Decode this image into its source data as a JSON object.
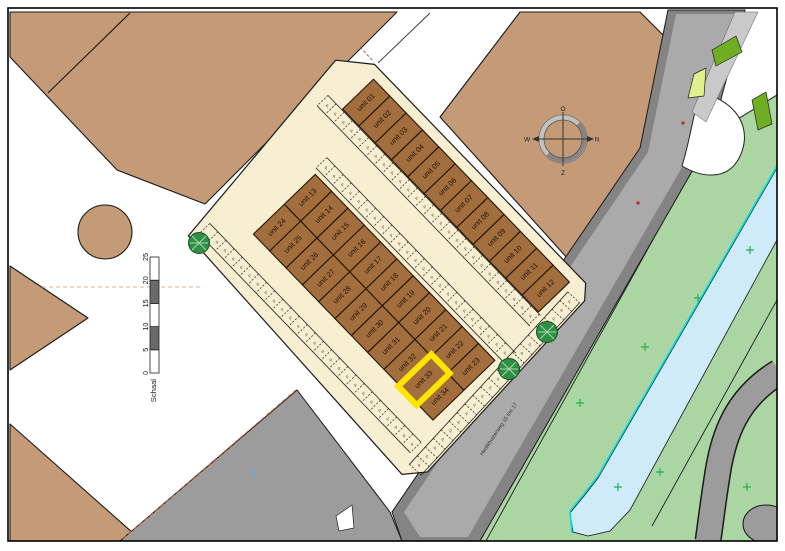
{
  "site": {
    "unit_labels": [
      "unit 01",
      "unit 02",
      "unit 03",
      "unit 04",
      "unit 05",
      "unit 06",
      "unit 07",
      "unit 08",
      "unit 09",
      "unit 10",
      "unit 11",
      "unit 12",
      "unit 13",
      "unit 14",
      "unit 15",
      "unit 16",
      "unit 17",
      "unit 18",
      "unit 19",
      "unit 20",
      "unit 21",
      "unit 22",
      "unit 23",
      "unit 24",
      "unit 25",
      "unit 26",
      "unit 27",
      "unit 28",
      "unit 29",
      "unit 30",
      "unit 31",
      "unit 32",
      "unit 33",
      "unit 34"
    ],
    "highlighted_unit": "unit 33",
    "parking_stall_glyph": "P"
  },
  "street": {
    "label": "Hedikhuizerweg 15 t/m 17"
  },
  "compass": {
    "top": "O",
    "right": "N",
    "bottom": "Z",
    "left": "W"
  },
  "scale_bar": {
    "label": "Schaal",
    "ticks": [
      "0",
      "5",
      "10",
      "15",
      "20",
      "25"
    ]
  },
  "colors": {
    "cream": "#f8eed2",
    "unit": "#a26e3e",
    "unit_border": "#241504",
    "highlight": "#ffe400",
    "parcel_tan": "#c49a77",
    "parcel_gray": "#9c9c9c",
    "road_light": "#aaaaaa",
    "road_dark": "#848484",
    "green": "#abd6a4",
    "green_dark": "#6fae22",
    "green_pale": "#dff08c",
    "canal_fill": "#cfeaf8",
    "canal_edge": "#00dde8",
    "tree": "#2f8f47",
    "plus_mark": "#21b24b",
    "red_dash": "#d4502a",
    "scale_dark": "#6a6a6a"
  }
}
